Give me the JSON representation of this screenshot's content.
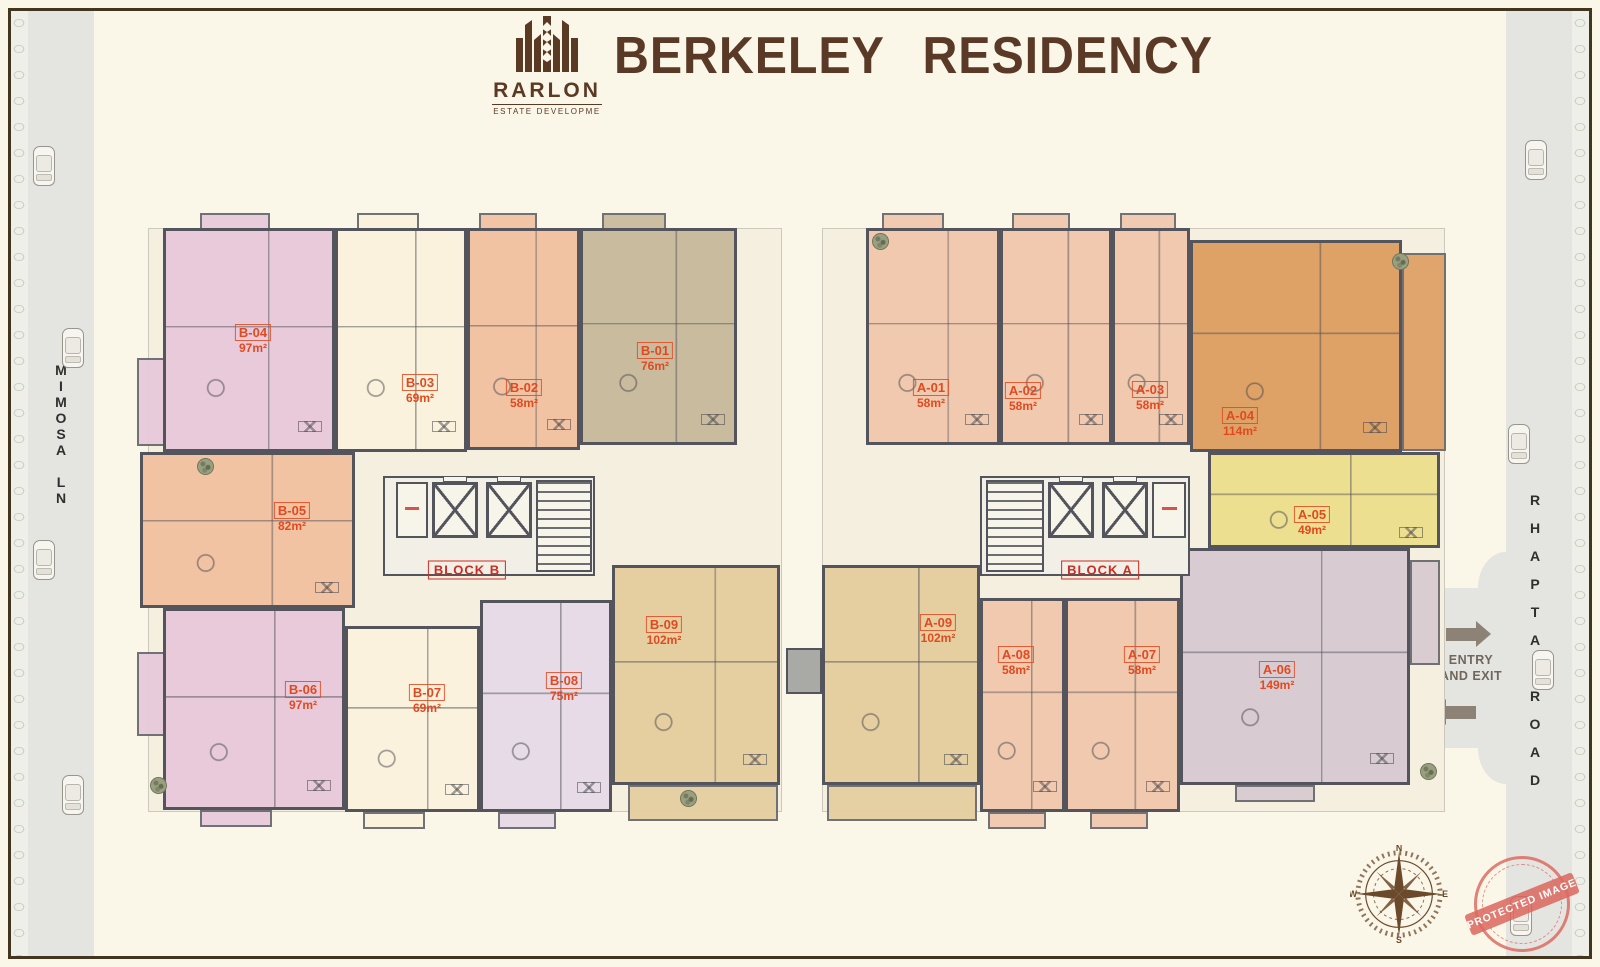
{
  "header": {
    "logo": {
      "name": "RARLON",
      "tagline": "ESTATE DEVELOPME",
      "icon": "building-wheat-logo-icon"
    },
    "title": "BERKELEY RESIDENCY"
  },
  "roads": {
    "left": {
      "name": "MIMOSA LN"
    },
    "right": {
      "name": "RHAPTA ROAD"
    }
  },
  "entry": {
    "line1": "ENTRY",
    "line2": "AND EXIT"
  },
  "compass": {
    "n": "N",
    "e": "E",
    "s": "S",
    "w": "W"
  },
  "stamp": {
    "text": "PROTECTED IMAGE"
  },
  "palette": {
    "pink": "#e8cadb",
    "cream": "#fbf2dd",
    "salmon_b": "#f2c3a3",
    "tan": "#c9bc9e",
    "lavender": "#e6dbe6",
    "khaki": "#e5cfa0",
    "salmon_a": "#f1c9af",
    "orange": "#dfa266",
    "yellow": "#ecdf90",
    "mauve": "#d8ccd2",
    "wall": "#54555c",
    "road": "#e4e4e0",
    "unit_label": "#e2491f",
    "block_label": "#cf2b20",
    "title": "#5a3a26"
  },
  "blocks": [
    {
      "id": "B",
      "label": "BLOCK B",
      "x": 148,
      "y": 228,
      "w": 634,
      "h": 584,
      "label_x": 467,
      "label_y": 570
    },
    {
      "id": "A",
      "label": "BLOCK A",
      "x": 822,
      "y": 228,
      "w": 623,
      "h": 584,
      "label_x": 1100,
      "label_y": 570
    }
  ],
  "units": [
    {
      "id": "B-04",
      "area": "97m²",
      "color": "pink",
      "x": 163,
      "y": 228,
      "w": 172,
      "h": 224,
      "lx": 253,
      "ly": 340
    },
    {
      "id": "B-03",
      "area": "69m²",
      "color": "cream",
      "x": 335,
      "y": 228,
      "w": 132,
      "h": 224,
      "lx": 420,
      "ly": 390
    },
    {
      "id": "B-02",
      "area": "58m²",
      "color": "salmon_b",
      "x": 467,
      "y": 228,
      "w": 113,
      "h": 222,
      "lx": 524,
      "ly": 395
    },
    {
      "id": "B-01",
      "area": "76m²",
      "color": "tan",
      "x": 580,
      "y": 228,
      "w": 157,
      "h": 217,
      "lx": 655,
      "ly": 358
    },
    {
      "id": "B-05",
      "area": "82m²",
      "color": "salmon_b",
      "x": 140,
      "y": 452,
      "w": 215,
      "h": 156,
      "lx": 292,
      "ly": 518
    },
    {
      "id": "B-06",
      "area": "97m²",
      "color": "pink",
      "x": 163,
      "y": 608,
      "w": 182,
      "h": 202,
      "lx": 303,
      "ly": 697
    },
    {
      "id": "B-07",
      "area": "69m²",
      "color": "cream",
      "x": 345,
      "y": 626,
      "w": 135,
      "h": 186,
      "lx": 427,
      "ly": 700
    },
    {
      "id": "B-08",
      "area": "75m²",
      "color": "lavender",
      "x": 480,
      "y": 600,
      "w": 132,
      "h": 212,
      "lx": 564,
      "ly": 688
    },
    {
      "id": "B-09",
      "area": "102m²",
      "color": "khaki",
      "x": 612,
      "y": 565,
      "w": 168,
      "h": 220,
      "lx": 664,
      "ly": 632
    },
    {
      "id": "A-01",
      "area": "58m²",
      "color": "salmon_a",
      "x": 866,
      "y": 228,
      "w": 134,
      "h": 217,
      "lx": 931,
      "ly": 395
    },
    {
      "id": "A-02",
      "area": "58m²",
      "color": "salmon_a",
      "x": 1000,
      "y": 228,
      "w": 112,
      "h": 217,
      "lx": 1023,
      "ly": 398
    },
    {
      "id": "A-03",
      "area": "58m²",
      "color": "salmon_a",
      "x": 1112,
      "y": 228,
      "w": 78,
      "h": 217,
      "lx": 1150,
      "ly": 397
    },
    {
      "id": "A-04",
      "area": "114m²",
      "color": "orange",
      "x": 1190,
      "y": 240,
      "w": 212,
      "h": 212,
      "lx": 1240,
      "ly": 423
    },
    {
      "id": "A-05",
      "area": "49m²",
      "color": "yellow",
      "x": 1208,
      "y": 452,
      "w": 232,
      "h": 96,
      "lx": 1312,
      "ly": 522
    },
    {
      "id": "A-06",
      "area": "149m²",
      "color": "mauve",
      "x": 1180,
      "y": 548,
      "w": 230,
      "h": 237,
      "lx": 1277,
      "ly": 677
    },
    {
      "id": "A-07",
      "area": "58m²",
      "color": "salmon_a",
      "x": 1065,
      "y": 598,
      "w": 115,
      "h": 214,
      "lx": 1142,
      "ly": 662
    },
    {
      "id": "A-08",
      "area": "58m²",
      "color": "salmon_a",
      "x": 980,
      "y": 598,
      "w": 85,
      "h": 214,
      "lx": 1016,
      "ly": 662
    },
    {
      "id": "A-09",
      "area": "102m²",
      "color": "khaki",
      "x": 822,
      "y": 565,
      "w": 158,
      "h": 220,
      "lx": 938,
      "ly": 630
    }
  ],
  "balconies": [
    [
      200,
      213,
      70,
      17,
      "pink"
    ],
    [
      357,
      213,
      62,
      17,
      "cream"
    ],
    [
      479,
      213,
      58,
      17,
      "salmon_b"
    ],
    [
      602,
      213,
      64,
      17,
      "tan"
    ],
    [
      882,
      213,
      62,
      17,
      "salmon_a"
    ],
    [
      1012,
      213,
      58,
      17,
      "salmon_a"
    ],
    [
      1120,
      213,
      56,
      17,
      "salmon_a"
    ],
    [
      137,
      358,
      28,
      88,
      "pink"
    ],
    [
      137,
      652,
      28,
      84,
      "pink"
    ],
    [
      1402,
      253,
      44,
      198,
      "orange"
    ],
    [
      1410,
      560,
      30,
      105,
      "mauve"
    ],
    [
      200,
      810,
      72,
      17,
      "pink"
    ],
    [
      363,
      812,
      62,
      17,
      "cream"
    ],
    [
      498,
      812,
      58,
      17,
      "lavender"
    ],
    [
      628,
      785,
      150,
      36,
      "khaki"
    ],
    [
      827,
      785,
      150,
      36,
      "khaki"
    ],
    [
      988,
      812,
      58,
      17,
      "salmon_a"
    ],
    [
      1090,
      812,
      58,
      17,
      "salmon_a"
    ],
    [
      1235,
      785,
      80,
      17,
      "mauve"
    ]
  ],
  "cores": {
    "b": {
      "service": [
        396,
        482,
        32,
        56
      ],
      "elevators": [
        [
          432,
          482,
          46,
          56
        ],
        [
          486,
          482,
          46,
          56
        ]
      ],
      "stairs": [
        536,
        480,
        56,
        92
      ],
      "hall": [
        383,
        476,
        212,
        100
      ]
    },
    "a": {
      "service": [
        1152,
        482,
        34,
        56
      ],
      "elevators": [
        [
          1048,
          482,
          46,
          56
        ],
        [
          1102,
          482,
          46,
          56
        ]
      ],
      "stairs": [
        986,
        480,
        58,
        92
      ],
      "hall": [
        980,
        476,
        210,
        100
      ]
    }
  },
  "connector": [
    786,
    648,
    36,
    46
  ],
  "cars": {
    "left": [
      [
        33,
        146
      ],
      [
        62,
        328
      ],
      [
        33,
        540
      ],
      [
        62,
        775
      ]
    ],
    "right": [
      [
        1525,
        140
      ],
      [
        1508,
        424
      ],
      [
        1532,
        650
      ],
      [
        1510,
        896
      ]
    ]
  },
  "trees": [
    [
      197,
      458
    ],
    [
      150,
      777
    ],
    [
      872,
      233
    ],
    [
      1392,
      253
    ],
    [
      1420,
      763
    ],
    [
      680,
      790
    ]
  ]
}
